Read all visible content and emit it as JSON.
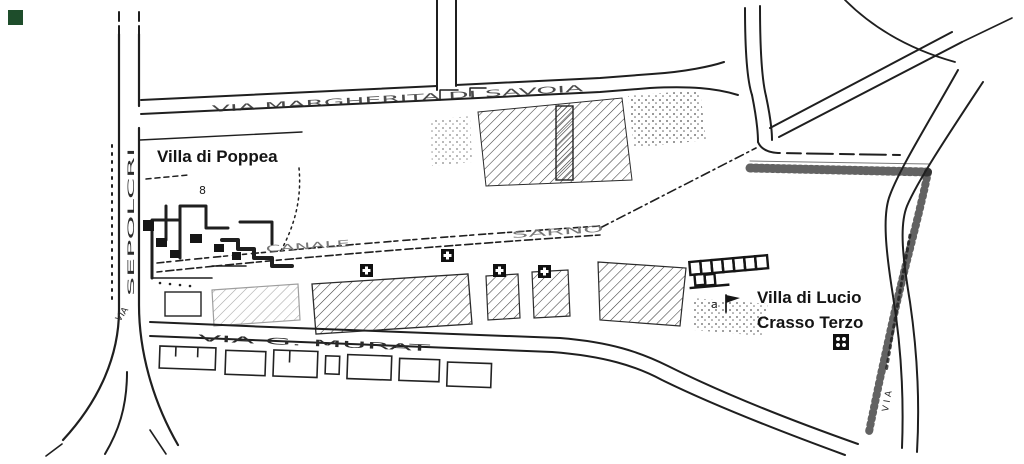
{
  "colors": {
    "paper": "#ffffff",
    "ink": "#1f1f1f",
    "faint_ink": "#6e6e6e",
    "corner_marker": "#1e4d2b",
    "corner_marker_css": "background:#1e4d2b"
  },
  "labels": {
    "villa_poppea": "Villa di Poppea",
    "villa_crasso_line1": "Villa di Lucio",
    "villa_crasso_line2": "Crasso Terzo",
    "plan_number": "8",
    "plan_letter": "a"
  },
  "streets": {
    "top": "VIA MARGHERITA DI SAVOIA",
    "bottom": "VIA G. MURAT",
    "left_name": "SEPOLCRI",
    "left_via": "VIA",
    "right_via": "VIA"
  },
  "canal": {
    "word1": "CANALE",
    "word2": "SARNO"
  }
}
